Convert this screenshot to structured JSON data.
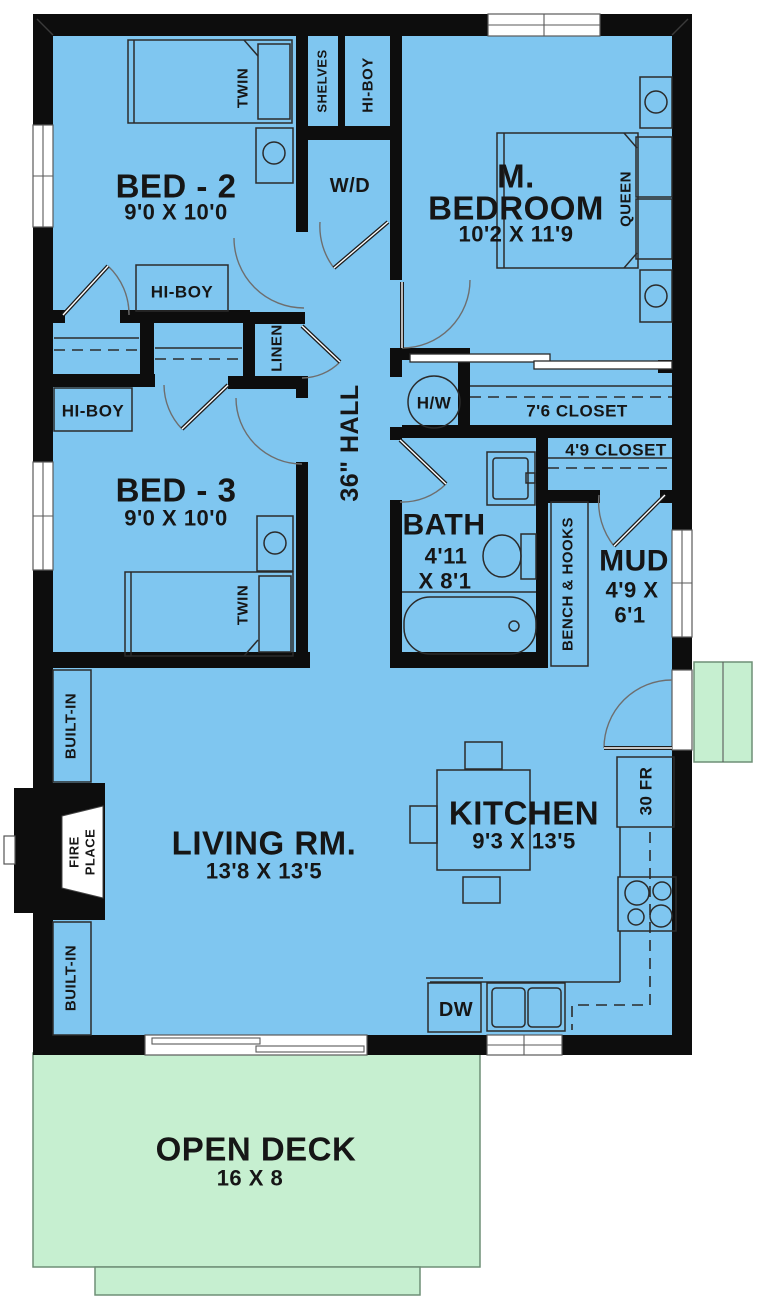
{
  "plan_title": "3-bedroom cottage floor plan",
  "colors": {
    "floor": "#7fc6f0",
    "deck": "#c6efd0",
    "wall": "#0d0d0d",
    "furniture_line": "#2b2b2b",
    "text": "#161616",
    "background": "#ffffff"
  },
  "rooms": {
    "bed2": {
      "name": "BED - 2",
      "dims": "9'0 X 10'0"
    },
    "master": {
      "line1": "M.",
      "line2": "BEDROOM",
      "dims": "10'2 X 11'9"
    },
    "bed3": {
      "name": "BED - 3",
      "dims": "9'0 X 10'0"
    },
    "bath": {
      "name": "BATH",
      "dims1": "4'11",
      "dims2": "X 8'1"
    },
    "mud": {
      "name": "MUD",
      "dims1": "4'9 X",
      "dims2": "6'1"
    },
    "living": {
      "name": "LIVING RM.",
      "dims": "13'8 X 13'5"
    },
    "kitchen": {
      "name": "KITCHEN",
      "dims": "9'3 X 13'5"
    },
    "deck": {
      "name": "OPEN DECK",
      "dims": "16 X 8"
    },
    "hall": {
      "name": "36\" HALL"
    }
  },
  "labels": {
    "twin": "TWIN",
    "queen": "QUEEN",
    "shelves": "SHELVES",
    "hiboy": "HI-BOY",
    "wd": "W/D",
    "linen": "LINEN",
    "hw": "H/W",
    "closet_76": "7'6 CLOSET",
    "closet_49": "4'9 CLOSET",
    "bench_hooks": "BENCH & HOOKS",
    "fridge_30": "30 FR",
    "dw": "DW",
    "builtin": "BUILT-IN",
    "fireplace_line1": "FIRE",
    "fireplace_line2": "PLACE"
  }
}
